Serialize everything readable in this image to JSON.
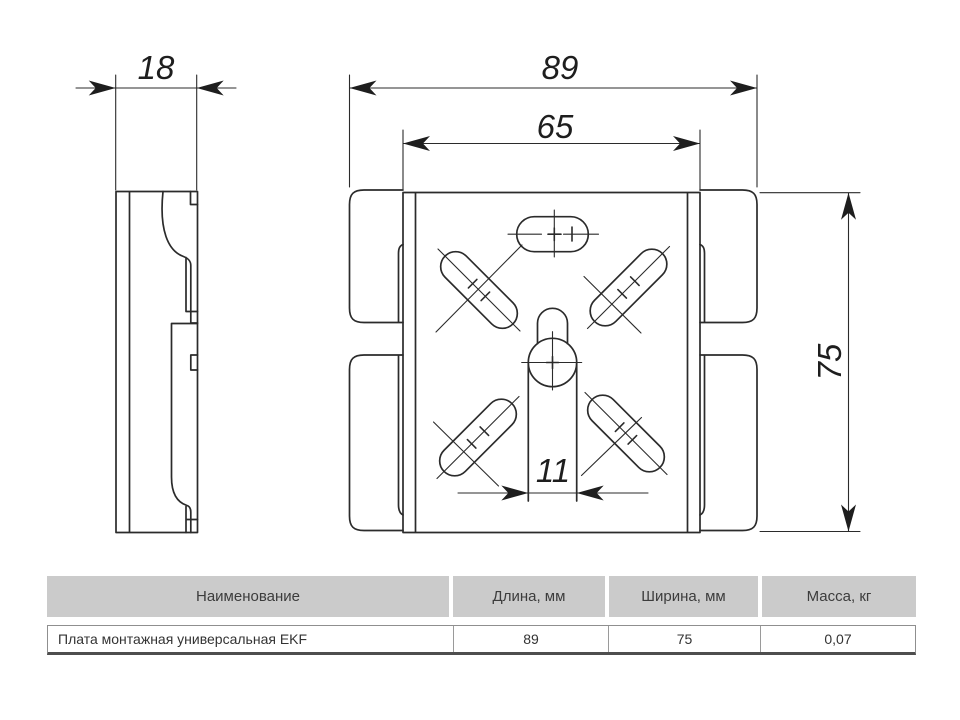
{
  "drawing": {
    "dimensions": {
      "side_thickness_mm": "18",
      "overall_width_mm": "89",
      "inner_width_mm": "65",
      "height_mm": "75",
      "keyhole_slot_width_mm": "11"
    }
  },
  "table": {
    "headers": [
      "Наименование",
      "Длина, мм",
      "Ширина, мм",
      "Масса, кг"
    ],
    "rows": [
      {
        "name": "Плата монтажная универсальная EKF",
        "length": "89",
        "width": "75",
        "weight": "0,07"
      }
    ]
  },
  "colors": {
    "line": "#2b2b2b",
    "table_header_bg": "#cbcbcb",
    "table_border": "#8f8f8f",
    "table_bottom_line": "#4e4e4e",
    "text": "#3a3a3a",
    "background": "#ffffff"
  }
}
